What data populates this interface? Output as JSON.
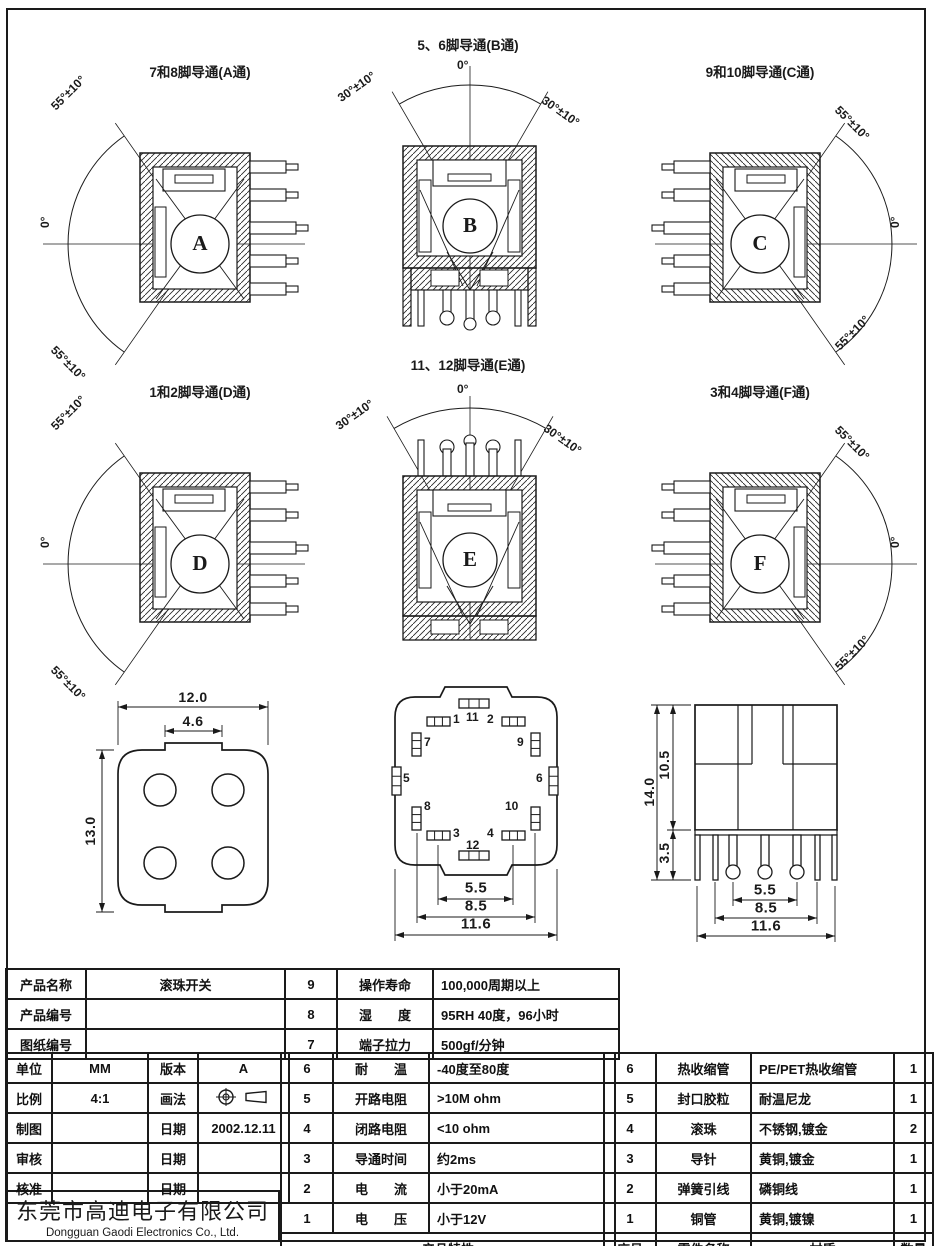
{
  "page": {
    "company_cn": "东莞市高迪电子有限公司",
    "company_en": "Dongguan Gaodi Electronics Co., Ltd."
  },
  "views": [
    {
      "letter": "A",
      "title": "7和8脚导通(A通)",
      "angles": [
        "55°±10°",
        "0°",
        "55°±10°"
      ]
    },
    {
      "letter": "B",
      "title": "5、6脚导通(B通)",
      "angles": [
        "30°±10°",
        "0°",
        "30°±10°"
      ]
    },
    {
      "letter": "C",
      "title": "9和10脚导通(C通)",
      "angles": [
        "55°±10°",
        "0°",
        "55°±10°"
      ]
    },
    {
      "letter": "D",
      "title": "1和2脚导通(D通)",
      "angles": [
        "55°±10°",
        "0°",
        "55°±10°"
      ]
    },
    {
      "letter": "E",
      "title": "11、12脚导通(E通)",
      "angles": [
        "30°±10°",
        "0°",
        "30°±10°"
      ]
    },
    {
      "letter": "F",
      "title": "3和4脚导通(F通)",
      "angles": [
        "55°±10°",
        "0°",
        "55°±10°"
      ]
    }
  ],
  "dim_views": {
    "bottom_view": {
      "width": "12.0",
      "notch": "4.6",
      "height": "13.0"
    },
    "pad_view": {
      "pins": [
        "1",
        "2",
        "3",
        "4",
        "5",
        "6",
        "7",
        "8",
        "9",
        "10",
        "11",
        "12"
      ],
      "dims": [
        "5.5",
        "8.5",
        "11.6"
      ]
    },
    "side_view": {
      "total_height": "14.0",
      "body_height": "10.5",
      "pin_length": "3.5",
      "dims": [
        "5.5",
        "8.5",
        "11.6"
      ]
    }
  },
  "title_block": {
    "info": [
      {
        "label": "产品名称",
        "value": "滚珠开关"
      },
      {
        "label": "产品编号",
        "value": ""
      },
      {
        "label": "图纸编号",
        "value": ""
      }
    ],
    "meta": [
      {
        "l1": "单位",
        "v1": "MM",
        "l2": "版本",
        "v2": "A"
      },
      {
        "l1": "比例",
        "v1": "4:1",
        "l2": "画法",
        "v2": ""
      },
      {
        "l1": "制图",
        "v1": "",
        "l2": "日期",
        "v2": "2002.12.11"
      },
      {
        "l1": "审核",
        "v1": "",
        "l2": "日期",
        "v2": ""
      },
      {
        "l1": "核准",
        "v1": "",
        "l2": "日期",
        "v2": ""
      }
    ],
    "props": [
      {
        "num": "9",
        "label": "操作寿命",
        "value": "100,000周期以上"
      },
      {
        "num": "8",
        "label": "湿　　度",
        "value": "95RH 40度，96小时"
      },
      {
        "num": "7",
        "label": "端子拉力",
        "value": "500gf/分钟"
      },
      {
        "num": "6",
        "label": "耐　　温",
        "value": "-40度至80度"
      },
      {
        "num": "5",
        "label": "开路电阻",
        "value": ">10M ohm"
      },
      {
        "num": "4",
        "label": "闭路电阻",
        "value": "<10 ohm"
      },
      {
        "num": "3",
        "label": "导通时间",
        "value": "约2ms"
      },
      {
        "num": "2",
        "label": "电　　流",
        "value": "小于20mA"
      },
      {
        "num": "1",
        "label": "电　　压",
        "value": "小于12V"
      }
    ],
    "props_footer": "产品特性",
    "parts": [
      {
        "num": "6",
        "name": "热收缩管",
        "material": "PE/PET热收缩管",
        "qty": "1"
      },
      {
        "num": "5",
        "name": "封口胶粒",
        "material": "耐温尼龙",
        "qty": "1"
      },
      {
        "num": "4",
        "name": "滚珠",
        "material": "不锈钢,镀金",
        "qty": "2"
      },
      {
        "num": "3",
        "name": "导针",
        "material": "黄铜,镀金",
        "qty": "1"
      },
      {
        "num": "2",
        "name": "弹簧引线",
        "material": "磷铜线",
        "qty": "1"
      },
      {
        "num": "1",
        "name": "铜管",
        "material": "黄铜,镀镍",
        "qty": "1"
      }
    ],
    "parts_header": {
      "num": "序号",
      "name": "零件名称",
      "material": "材质",
      "qty": "数量"
    }
  },
  "colors": {
    "ink": "#1a1a1a",
    "paper": "#ffffff"
  }
}
